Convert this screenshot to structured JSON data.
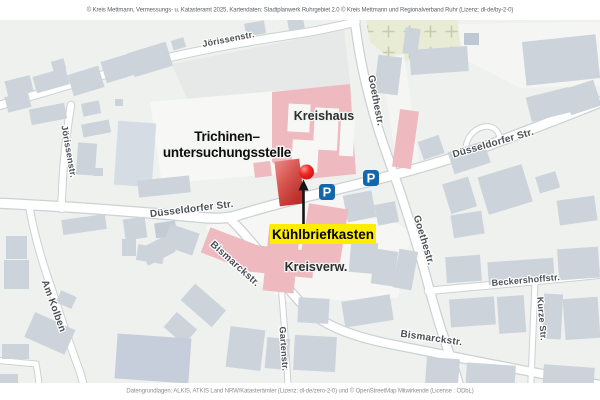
{
  "attribution": {
    "top": "© Kreis Mettmann, Vermessungs- u. Katasteramt 2025, Kartendaten: Stadtplanwerk Ruhrgebiet 2.0 © Kreis Mettmann und Regionalverband Ruhr (Lizenz: dl-de/by-2-0)",
    "bottom": "Datengrundlagen: ALKIS, ATKIS Land NRW/Katasterämter (Lizenz: dl-de/zero-2-0) und © OpenStreetMap Mitwirkende (License : ODbL)"
  },
  "map": {
    "streets": {
      "jorissenstr": "Jörissenstr.",
      "duesseldorfer_str": "Düsseldorfer Str.",
      "goethestr": "Goethestr.",
      "am_kolben": "Am Kolben",
      "bismarckstr": "Bismarckstr.",
      "gartenstr": "Gartenstr.",
      "beckershoffstr": "Beckershoffstr.",
      "kurze_str": "Kurze Str."
    },
    "places": {
      "kreishaus": "Kreishaus",
      "kreisverwaltung": "Kreisverw.",
      "poi_line1": "Trichinen–",
      "poi_line2": "untersuchungsstelle"
    },
    "callout": {
      "label": "Kühlbriefkasten"
    },
    "parking": {
      "label": "P"
    },
    "colors": {
      "callout_yellow": "#ffed00",
      "marker_red": "#e2231a",
      "poi_building_red": "#c9403a",
      "public_building_pink": "#efbabf",
      "building_gray": "#ccd3db",
      "parking_blue": "#1367ad",
      "cemetery_green": "#e9ecd5",
      "background": "#eef1ee"
    }
  }
}
